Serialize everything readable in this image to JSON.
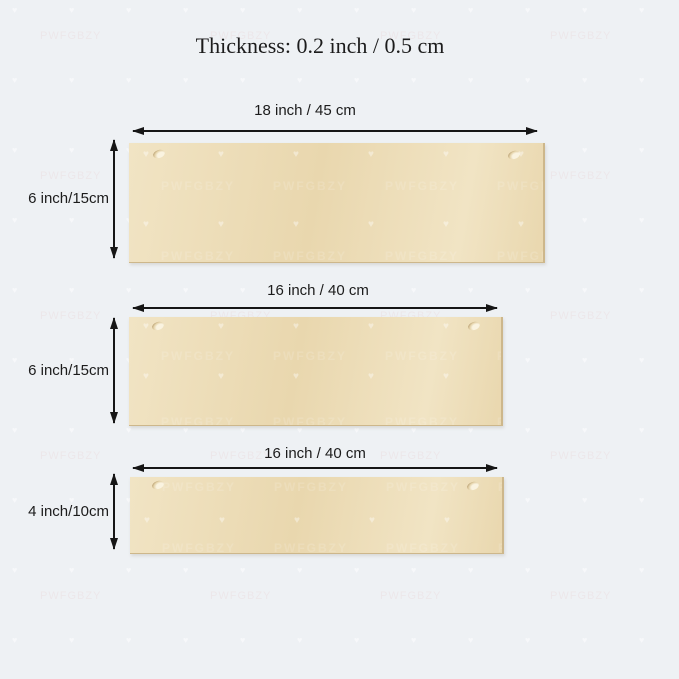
{
  "title": "Thickness: 0.2 inch / 0.5 cm",
  "boards": [
    {
      "width_label": "18 inch  /  45 cm",
      "height_label": "6 inch/15cm"
    },
    {
      "width_label": "16 inch  /  40 cm",
      "height_label": "6 inch/15cm"
    },
    {
      "width_label": "16 inch  /  40 cm",
      "height_label": "4 inch/10cm"
    }
  ],
  "watermark": {
    "text": "PWFGBZY",
    "heart": "♥"
  },
  "colors": {
    "background": "#eef1f4",
    "board_light": "#f1e4c4",
    "board_dark": "#e9d7ae",
    "board_edge": "#cdb78b",
    "arrow": "#161616",
    "text": "#1c1c1c"
  }
}
